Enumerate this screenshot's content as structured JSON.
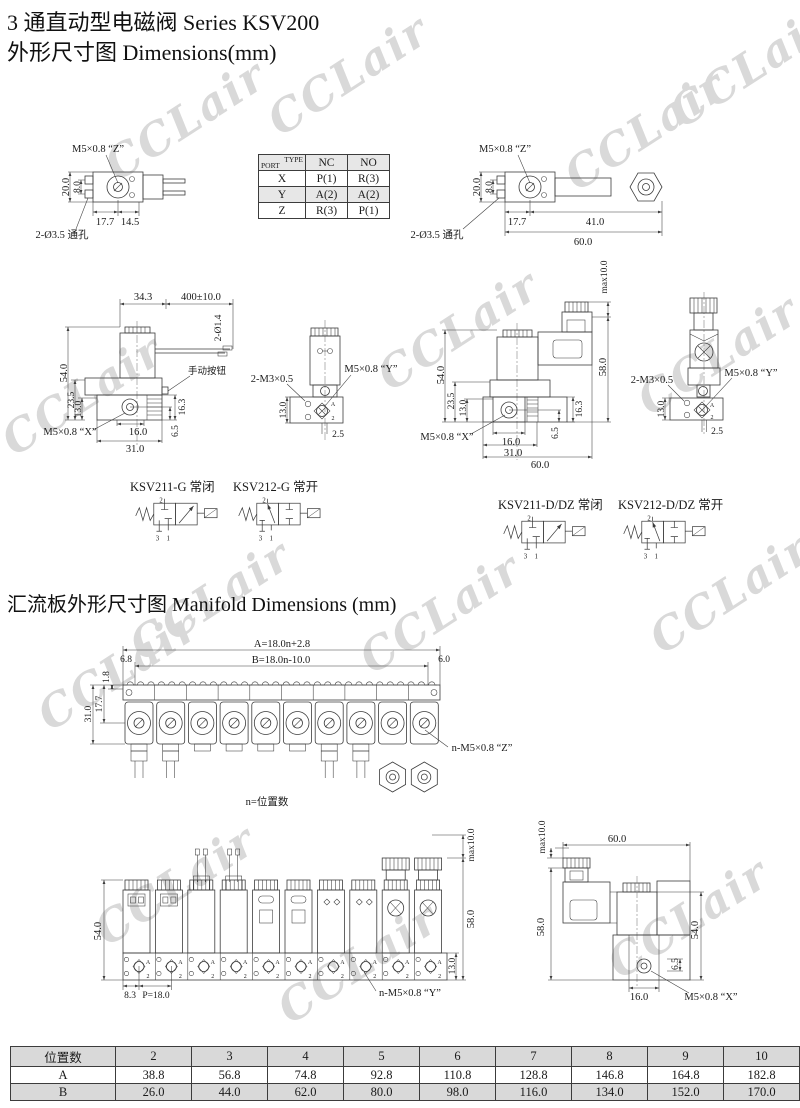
{
  "page": {
    "title_line1": "3 通直动型电磁阀 Series KSV200",
    "title_line2": "外形尺寸图 Dimensions(mm)",
    "manifold_heading": "汇流板外形尺寸图 Manifold Dimensions (mm)",
    "watermark": "CCLair",
    "note_n": "n=位置数"
  },
  "port_table": {
    "corner": {
      "top": "TYPE",
      "bottom": "PORT"
    },
    "columns": [
      "NC",
      "NO"
    ],
    "rows": [
      {
        "port": "X",
        "nc": "P(1)",
        "no": "R(3)"
      },
      {
        "port": "Y",
        "nc": "A(2)",
        "no": "A(2)"
      },
      {
        "port": "Z",
        "nc": "R(3)",
        "no": "P(1)"
      }
    ]
  },
  "dims": {
    "top_left": {
      "thread_z": "M5×0.8 “Z”",
      "holes": "2-Ø3.5 通孔",
      "d20": "20.0",
      "d8": "8.0",
      "d177": "17.7",
      "d145": "14.5"
    },
    "top_right": {
      "thread_z": "M5×0.8 “Z”",
      "holes": "2-Ø3.5 通孔",
      "d20": "20.0",
      "d8": "8.0",
      "d177": "17.7",
      "d41": "41.0",
      "d60": "60.0"
    },
    "side_g": {
      "d343": "34.3",
      "wire": "400±10.0",
      "wire_dia": "2-Ø1.4",
      "manual_btn": "手动按钮",
      "d54": "54.0",
      "d235": "23.5",
      "d13": "13.0",
      "thread_x": "M5×0.8 “X”",
      "d16": "16.0",
      "d31": "31.0",
      "d163": "16.3",
      "d65": "6.5"
    },
    "front_g": {
      "screws": "2-M3×0.5",
      "thread_y": "M5×0.8 “Y”",
      "d13": "13.0",
      "d25": "2.5",
      "port_a": "A",
      "port_2": "2"
    },
    "side_d": {
      "max": "max10.0",
      "d58": "58.0",
      "d54": "54.0",
      "d235": "23.5",
      "d13": "13.0",
      "thread_x": "M5×0.8 “X”",
      "d16": "16.0",
      "d31": "31.0",
      "d60": "60.0",
      "d163": "16.3",
      "d65": "6.5"
    },
    "front_d": {
      "screws": "2-M3×0.5",
      "thread_y": "M5×0.8 “Y”",
      "d13": "13.0",
      "d25": "2.5",
      "port_a": "A",
      "port_2": "2"
    },
    "manifold_top": {
      "dim_a": "A=18.0n+2.8",
      "dim_b": "B=18.0n-10.0",
      "d68": "6.8",
      "d60": "6.0",
      "d18": "1.8",
      "d177": "17.7",
      "d31": "31.0",
      "thread_z": "n-M5×0.8 “Z”"
    },
    "manifold_front": {
      "d54": "54.0",
      "max": "max10.0",
      "d58": "58.0",
      "d13": "13.0",
      "d83": "8.3",
      "pitch": "P=18.0",
      "thread_y": "n-M5×0.8 “Y”",
      "port_a": "A",
      "port_2": "2"
    },
    "manifold_side": {
      "max": "max10.0",
      "d60": "60.0",
      "d58": "58.0",
      "d54": "54.0",
      "d65": "6.5",
      "d16": "16.0",
      "thread_x": "M5×0.8 “X”"
    }
  },
  "symbols": [
    {
      "label": "KSV211-G 常闭",
      "p2": "2",
      "p3": "3",
      "p1": "1"
    },
    {
      "label": "KSV212-G 常开",
      "p2": "2",
      "p3": "3",
      "p1": "1"
    },
    {
      "label": "KSV211-D/DZ 常闭",
      "p2": "2",
      "p3": "3",
      "p1": "1"
    },
    {
      "label": "KSV212-D/DZ 常开",
      "p2": "2",
      "p3": "3",
      "p1": "1"
    }
  ],
  "size_table": {
    "row_header": "位置数",
    "positions": [
      "2",
      "3",
      "4",
      "5",
      "6",
      "7",
      "8",
      "9",
      "10"
    ],
    "rows": [
      {
        "label": "A",
        "values": [
          "38.8",
          "56.8",
          "74.8",
          "92.8",
          "110.8",
          "128.8",
          "146.8",
          "164.8",
          "182.8"
        ]
      },
      {
        "label": "B",
        "values": [
          "26.0",
          "44.0",
          "62.0",
          "80.0",
          "98.0",
          "116.0",
          "134.0",
          "152.0",
          "170.0"
        ]
      }
    ]
  }
}
